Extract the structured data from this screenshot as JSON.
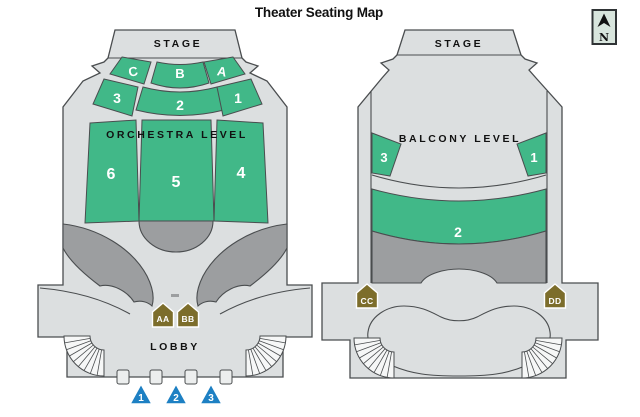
{
  "title": "Theater Seating Map",
  "compass": {
    "north_label": "N"
  },
  "colors": {
    "section_green": "#41b888",
    "floor_gray": "#dcdfe0",
    "shade_gray": "#9c9ea0",
    "marker_olive": "#7c6d2b",
    "entrance_blue": "#1d80c3",
    "outline": "#4a4d4f",
    "compass_bg": "#d8e5dd"
  },
  "orchestra": {
    "stage_label": "STAGE",
    "level_label": "ORCHESTRA LEVEL",
    "lobby_label": "LOBBY",
    "sections": {
      "a": "A",
      "b": "B",
      "c": "C",
      "n1": "1",
      "n2": "2",
      "n3": "3",
      "n4": "4",
      "n5": "5",
      "n6": "6"
    },
    "markers": {
      "aa": "AA",
      "bb": "BB"
    },
    "entrances": [
      "1",
      "2",
      "3"
    ]
  },
  "balcony": {
    "stage_label": "STAGE",
    "level_label": "BALCONY LEVEL",
    "sections": {
      "n1": "1",
      "n2": "2",
      "n3": "3"
    },
    "markers": {
      "cc": "CC",
      "dd": "DD"
    }
  }
}
